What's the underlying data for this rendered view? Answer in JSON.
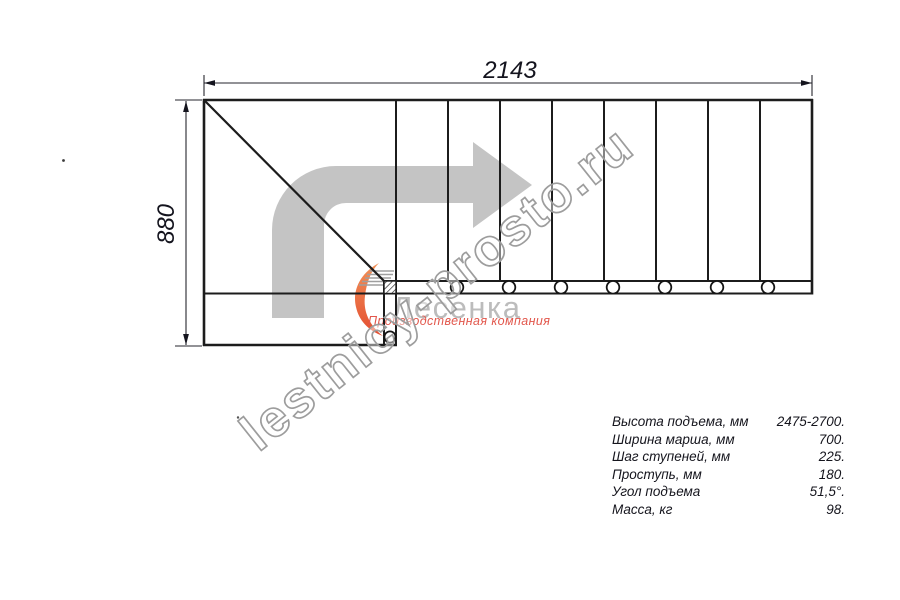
{
  "drawing": {
    "type": "staircase-plan-top-view",
    "dim_width_mm": "2143",
    "dim_height_mm": "880",
    "direction_arrow_icon": "walk-up-then-turn-right-arrow",
    "tread_count_straight": 8,
    "winder_treads": 2,
    "baluster_circles": 8
  },
  "logo": {
    "company": "Лесенка",
    "tagline": "Производственная компания",
    "swoosh_color": "#ef7a3e",
    "tagline_color": "#e2574c"
  },
  "watermark": {
    "text": "lestnicy-prosto.ru"
  },
  "specs": {
    "rows": [
      {
        "label": "Высота подъема, мм",
        "value": "2475-2700."
      },
      {
        "label": "Ширина марша, мм",
        "value": "700."
      },
      {
        "label": "Шаг ступеней, мм",
        "value": "225."
      },
      {
        "label": "Проступь, мм",
        "value": "180."
      },
      {
        "label": "Угол подъема",
        "value": "51,5°."
      },
      {
        "label": "Масса, кг",
        "value": "98."
      }
    ]
  },
  "colors": {
    "line": "#1c1c1c",
    "arrow_fill": "#c4c4c4",
    "watermark_stroke": "#9d9d9d",
    "background": "#ffffff"
  }
}
